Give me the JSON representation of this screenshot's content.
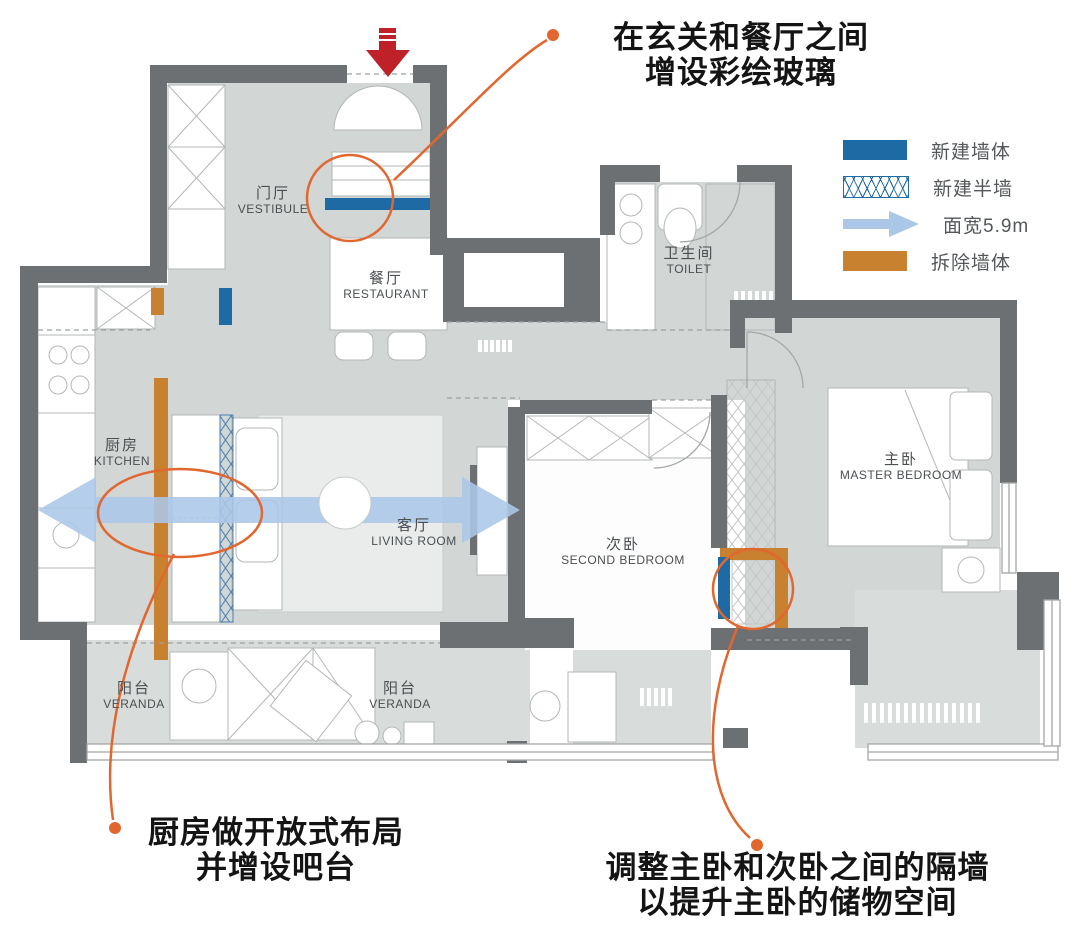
{
  "colors": {
    "floor": "#d2d6d5",
    "floor-light": "#d8dcdb",
    "wall": "#6d7072",
    "furn-stroke": "#b3b7b6",
    "new-wall": "#1d6aa5",
    "demolish-wall": "#c8812f",
    "width-arrow": "#abc7e8",
    "annotation": "#e2672f",
    "entrance-arrow": "#bf2129",
    "label": "#4b4f51",
    "annotation-text": "#141414"
  },
  "legend": {
    "items": [
      {
        "label": "新建墙体",
        "type": "new-wall"
      },
      {
        "label": "新建半墙",
        "type": "new-half-wall"
      },
      {
        "label": "面宽5.9m",
        "type": "width-arrow"
      },
      {
        "label": "拆除墙体",
        "type": "demolish-wall"
      }
    ]
  },
  "rooms": [
    {
      "id": "vestibule",
      "cn": "门厅",
      "en": "VESTIBULE"
    },
    {
      "id": "restaurant",
      "cn": "餐厅",
      "en": "RESTAURANT"
    },
    {
      "id": "toilet",
      "cn": "卫生间",
      "en": "TOILET"
    },
    {
      "id": "kitchen",
      "cn": "厨房",
      "en": "KITCHEN"
    },
    {
      "id": "living-room",
      "cn": "客厅",
      "en": "LIVING ROOM"
    },
    {
      "id": "second-bedroom",
      "cn": "次卧",
      "en": "SECOND BEDROOM"
    },
    {
      "id": "master-bedroom",
      "cn": "主卧",
      "en": "MASTER BEDROOM"
    },
    {
      "id": "veranda-left",
      "cn": "阳台",
      "en": "VERANDA"
    },
    {
      "id": "veranda-center",
      "cn": "阳台",
      "en": "VERANDA"
    }
  ],
  "annotations": {
    "stained_glass": {
      "line1": "在玄关和餐厅之间",
      "line2": "增设彩绘玻璃"
    },
    "open_kitchen": {
      "line1": "厨房做开放式布局",
      "line2": "并增设吧台"
    },
    "partition": {
      "line1": "调整主卧和次卧之间的隔墙",
      "line2": "以提升主卧的储物空间"
    }
  }
}
